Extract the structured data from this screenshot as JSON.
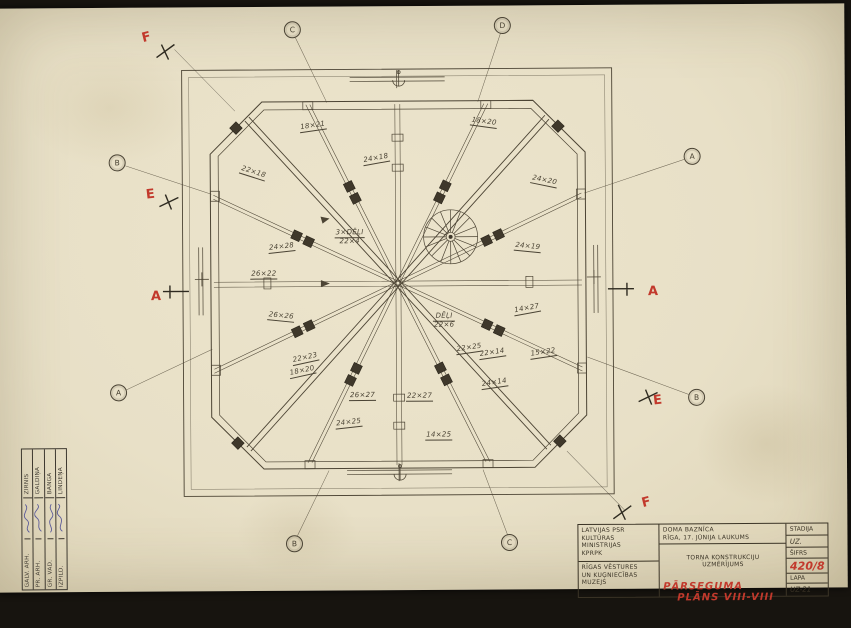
{
  "colors": {
    "paper": "#e8e0c7",
    "line": "#4c4434",
    "ink": "#3b3426",
    "red": "#c2392c",
    "signature": "#5c5c99"
  },
  "drawing": {
    "section_letters": [
      {
        "label": "F",
        "x": 152,
        "y": 30,
        "rot": -14
      },
      {
        "label": "E",
        "x": 155,
        "y": 187,
        "rot": -6
      },
      {
        "label": "A",
        "x": 160,
        "y": 289,
        "rot": 0
      },
      {
        "label": "A",
        "x": 657,
        "y": 287,
        "rot": 0
      },
      {
        "label": "E",
        "x": 661,
        "y": 396,
        "rot": -6
      },
      {
        "label": "F",
        "x": 649,
        "y": 498,
        "rot": -14
      }
    ],
    "grid_bubbles": [
      {
        "label": "C",
        "x": 298,
        "y": 23
      },
      {
        "label": "D",
        "x": 508,
        "y": 20
      },
      {
        "label": "B",
        "x": 122,
        "y": 155
      },
      {
        "label": "A",
        "x": 122,
        "y": 385
      },
      {
        "label": "A",
        "x": 697,
        "y": 152
      },
      {
        "label": "B",
        "x": 700,
        "y": 393
      },
      {
        "label": "B",
        "x": 297,
        "y": 537
      },
      {
        "label": "C",
        "x": 512,
        "y": 537
      }
    ],
    "dimension_labels": [
      {
        "lines": [
          "18×21"
        ],
        "x": 318,
        "y": 120,
        "rot": -8
      },
      {
        "lines": [
          "18×20"
        ],
        "x": 489,
        "y": 117,
        "rot": 8
      },
      {
        "lines": [
          "24×18"
        ],
        "x": 381,
        "y": 153,
        "rot": -10
      },
      {
        "lines": [
          "24×20"
        ],
        "x": 549,
        "y": 176,
        "rot": 12
      },
      {
        "lines": [
          "22×18"
        ],
        "x": 258,
        "y": 166,
        "rot": 18
      },
      {
        "lines": [
          "24×28"
        ],
        "x": 286,
        "y": 241,
        "rot": -6
      },
      {
        "lines": [
          "3×DĒĻI",
          "22×4"
        ],
        "x": 354,
        "y": 231,
        "rot": 0
      },
      {
        "lines": [
          "24×19"
        ],
        "x": 532,
        "y": 242,
        "rot": 6
      },
      {
        "lines": [
          "26×26"
        ],
        "x": 285,
        "y": 310,
        "rot": 6
      },
      {
        "lines": [
          "DĒĻI",
          "22×6"
        ],
        "x": 448,
        "y": 315,
        "rot": 0
      },
      {
        "lines": [
          "14×27"
        ],
        "x": 531,
        "y": 304,
        "rot": -10
      },
      {
        "lines": [
          "26×22"
        ],
        "x": 268,
        "y": 268,
        "rot": 0
      },
      {
        "lines": [
          "22×14"
        ],
        "x": 496,
        "y": 348,
        "rot": -8
      },
      {
        "lines": [
          "15×22"
        ],
        "x": 547,
        "y": 348,
        "rot": -8
      },
      {
        "lines": [
          "24×14"
        ],
        "x": 498,
        "y": 378,
        "rot": -8
      },
      {
        "lines": [
          "22×23"
        ],
        "x": 309,
        "y": 352,
        "rot": -12
      },
      {
        "lines": [
          "18×20"
        ],
        "x": 306,
        "y": 365,
        "rot": -12
      },
      {
        "lines": [
          "26×27"
        ],
        "x": 366,
        "y": 390,
        "rot": 0
      },
      {
        "lines": [
          "22×27"
        ],
        "x": 423,
        "y": 391,
        "rot": 0
      },
      {
        "lines": [
          "22×25"
        ],
        "x": 473,
        "y": 343,
        "rot": -8
      },
      {
        "lines": [
          "24×25"
        ],
        "x": 352,
        "y": 417,
        "rot": -6
      },
      {
        "lines": [
          "14×25"
        ],
        "x": 442,
        "y": 430,
        "rot": 0
      }
    ]
  },
  "title_block": {
    "org_top": "LATVIJAS PSR\nKULTŪRAS\nMINISTRIJAS\nKPRPK",
    "org_bottom": "RĪGAS VĒSTURES\nUN KUĢNIECĪBAS\nMUZEJS",
    "object": "DOMA BAZNĪCA\nRĪGA, 17. JŪNIJA LAUKUMS",
    "project": "TORŅA KONSTRUKCIJU\nUZMĒRĪJUMS",
    "sheet_title_line1": "PĀRSEGUMA",
    "sheet_title_line2": "PLĀNS VIII-VIII",
    "stage_label": "STADIJA",
    "stage_value": "UZ.",
    "code_label": "ŠIFRS",
    "code_value": "420/8",
    "page_label": "LAPA",
    "page_value": "UZ-21"
  },
  "stamp": {
    "rows": [
      {
        "role": "GALV. ARH.",
        "name": "ZIRNIS"
      },
      {
        "role": "PR. ARH.",
        "name": "GALDIŅA"
      },
      {
        "role": "GR. VAD.",
        "name": "BANGA"
      },
      {
        "role": "IZPILD.",
        "name": "LINDEŅA"
      }
    ]
  }
}
